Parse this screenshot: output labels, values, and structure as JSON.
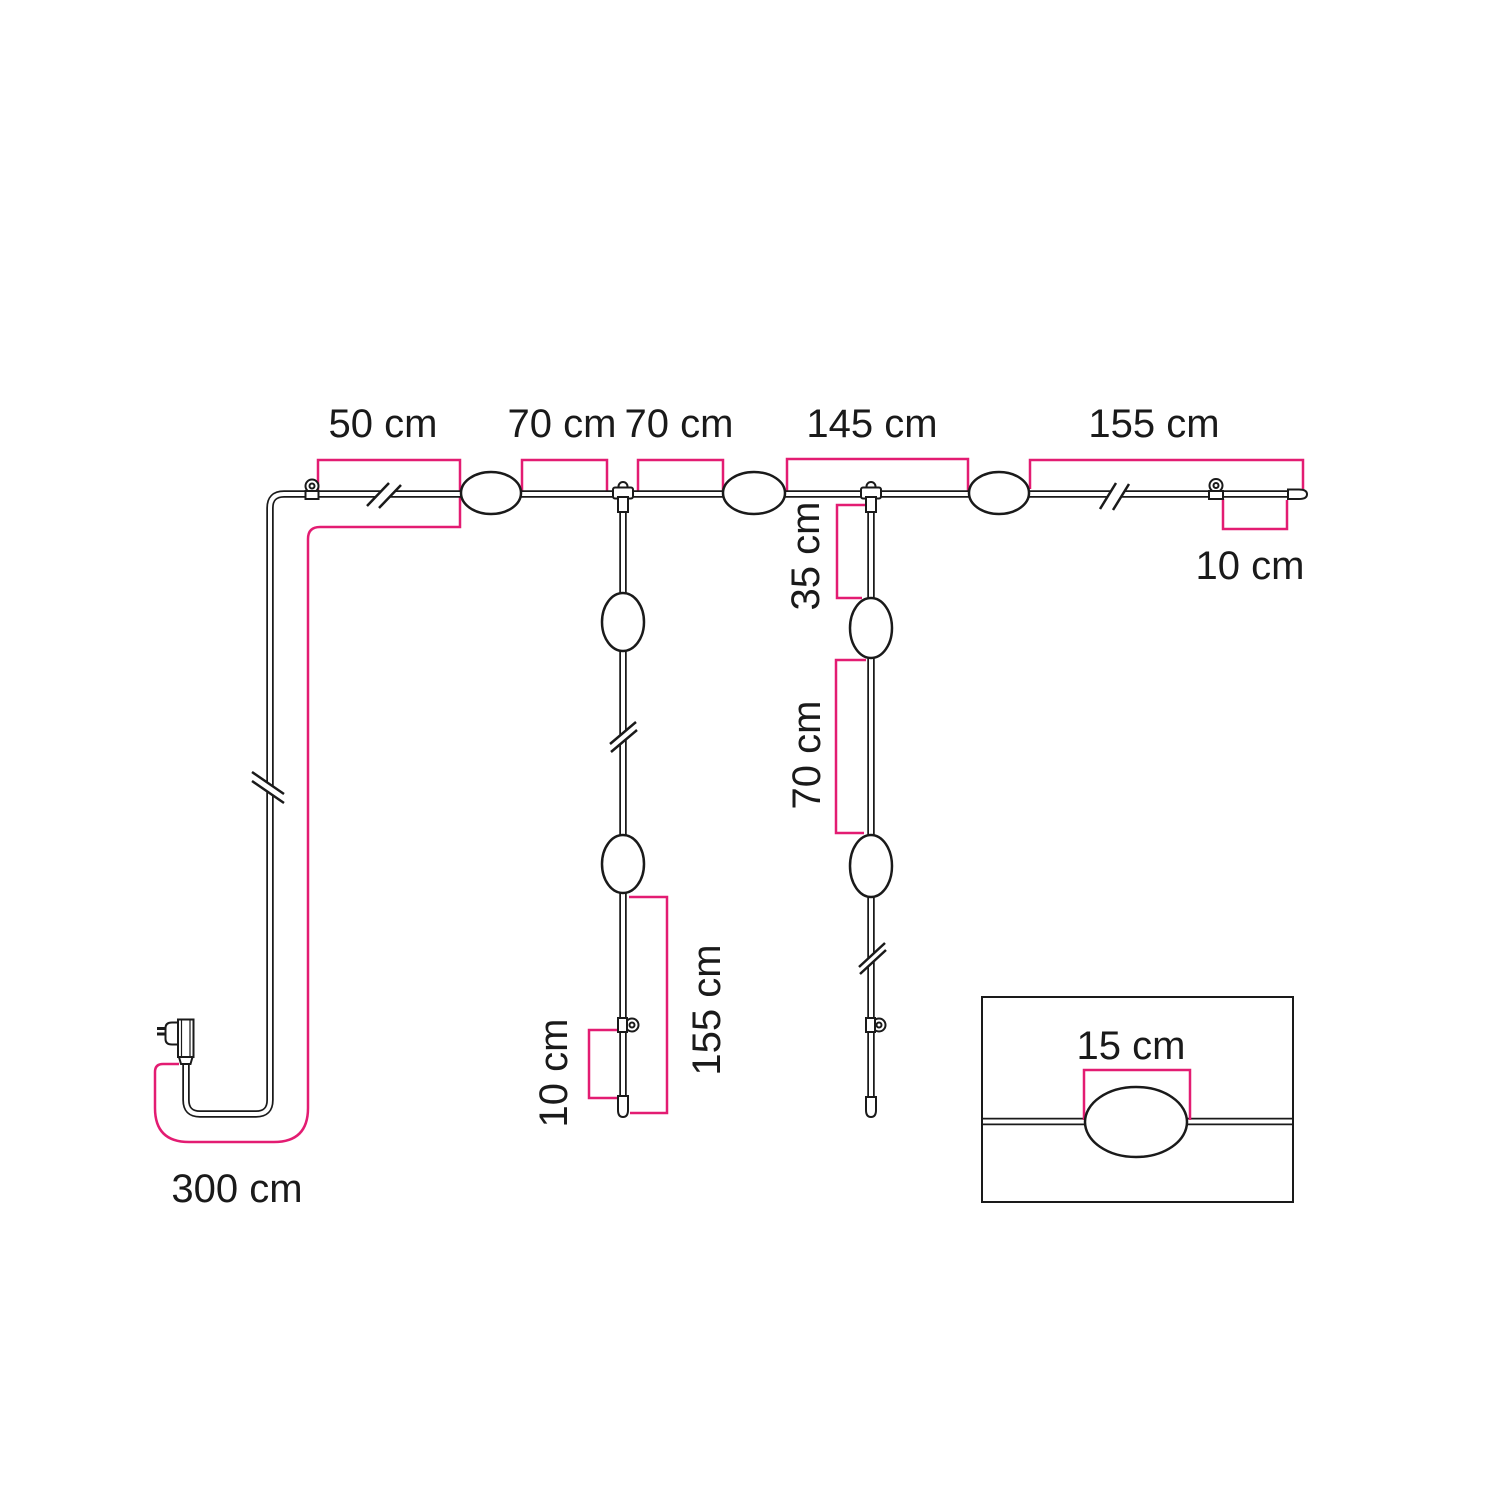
{
  "diagram": {
    "name": "string-light-installation-measurement-diagram",
    "unit": "cm",
    "colors": {
      "dimension_line": "#e31c72",
      "drawing_line": "#1a1a1a",
      "background": "#ffffff"
    }
  },
  "dimensions": {
    "top_run": [
      {
        "label": "50 cm",
        "value": 50
      },
      {
        "label": "70 cm",
        "value": 70
      },
      {
        "label": "70 cm",
        "value": 70
      },
      {
        "label": "145 cm",
        "value": 145
      },
      {
        "label": "155 cm",
        "value": 155
      }
    ],
    "top_end_offset": {
      "label": "10 cm",
      "value": 10
    },
    "right_drop_upper": {
      "label": "35 cm",
      "value": 35
    },
    "right_drop_lower": {
      "label": "70 cm",
      "value": 70
    },
    "left_drop_length": {
      "label": "155 cm",
      "value": 155
    },
    "left_drop_end_offset": {
      "label": "10 cm",
      "value": 10
    },
    "power_cable": {
      "label": "300 cm",
      "value": 300
    },
    "inset_lamp": {
      "label": "15 cm",
      "value": 15
    }
  },
  "components": {
    "plug": "power-plug-icon",
    "lamp": "lamp-oval",
    "hook": "mounting-eyelet-hook",
    "t_connector": "t-junction-connector",
    "end_cap": "cable-end-cap",
    "break_mark": "cable-length-break",
    "inset": "lamp-detail-inset"
  }
}
